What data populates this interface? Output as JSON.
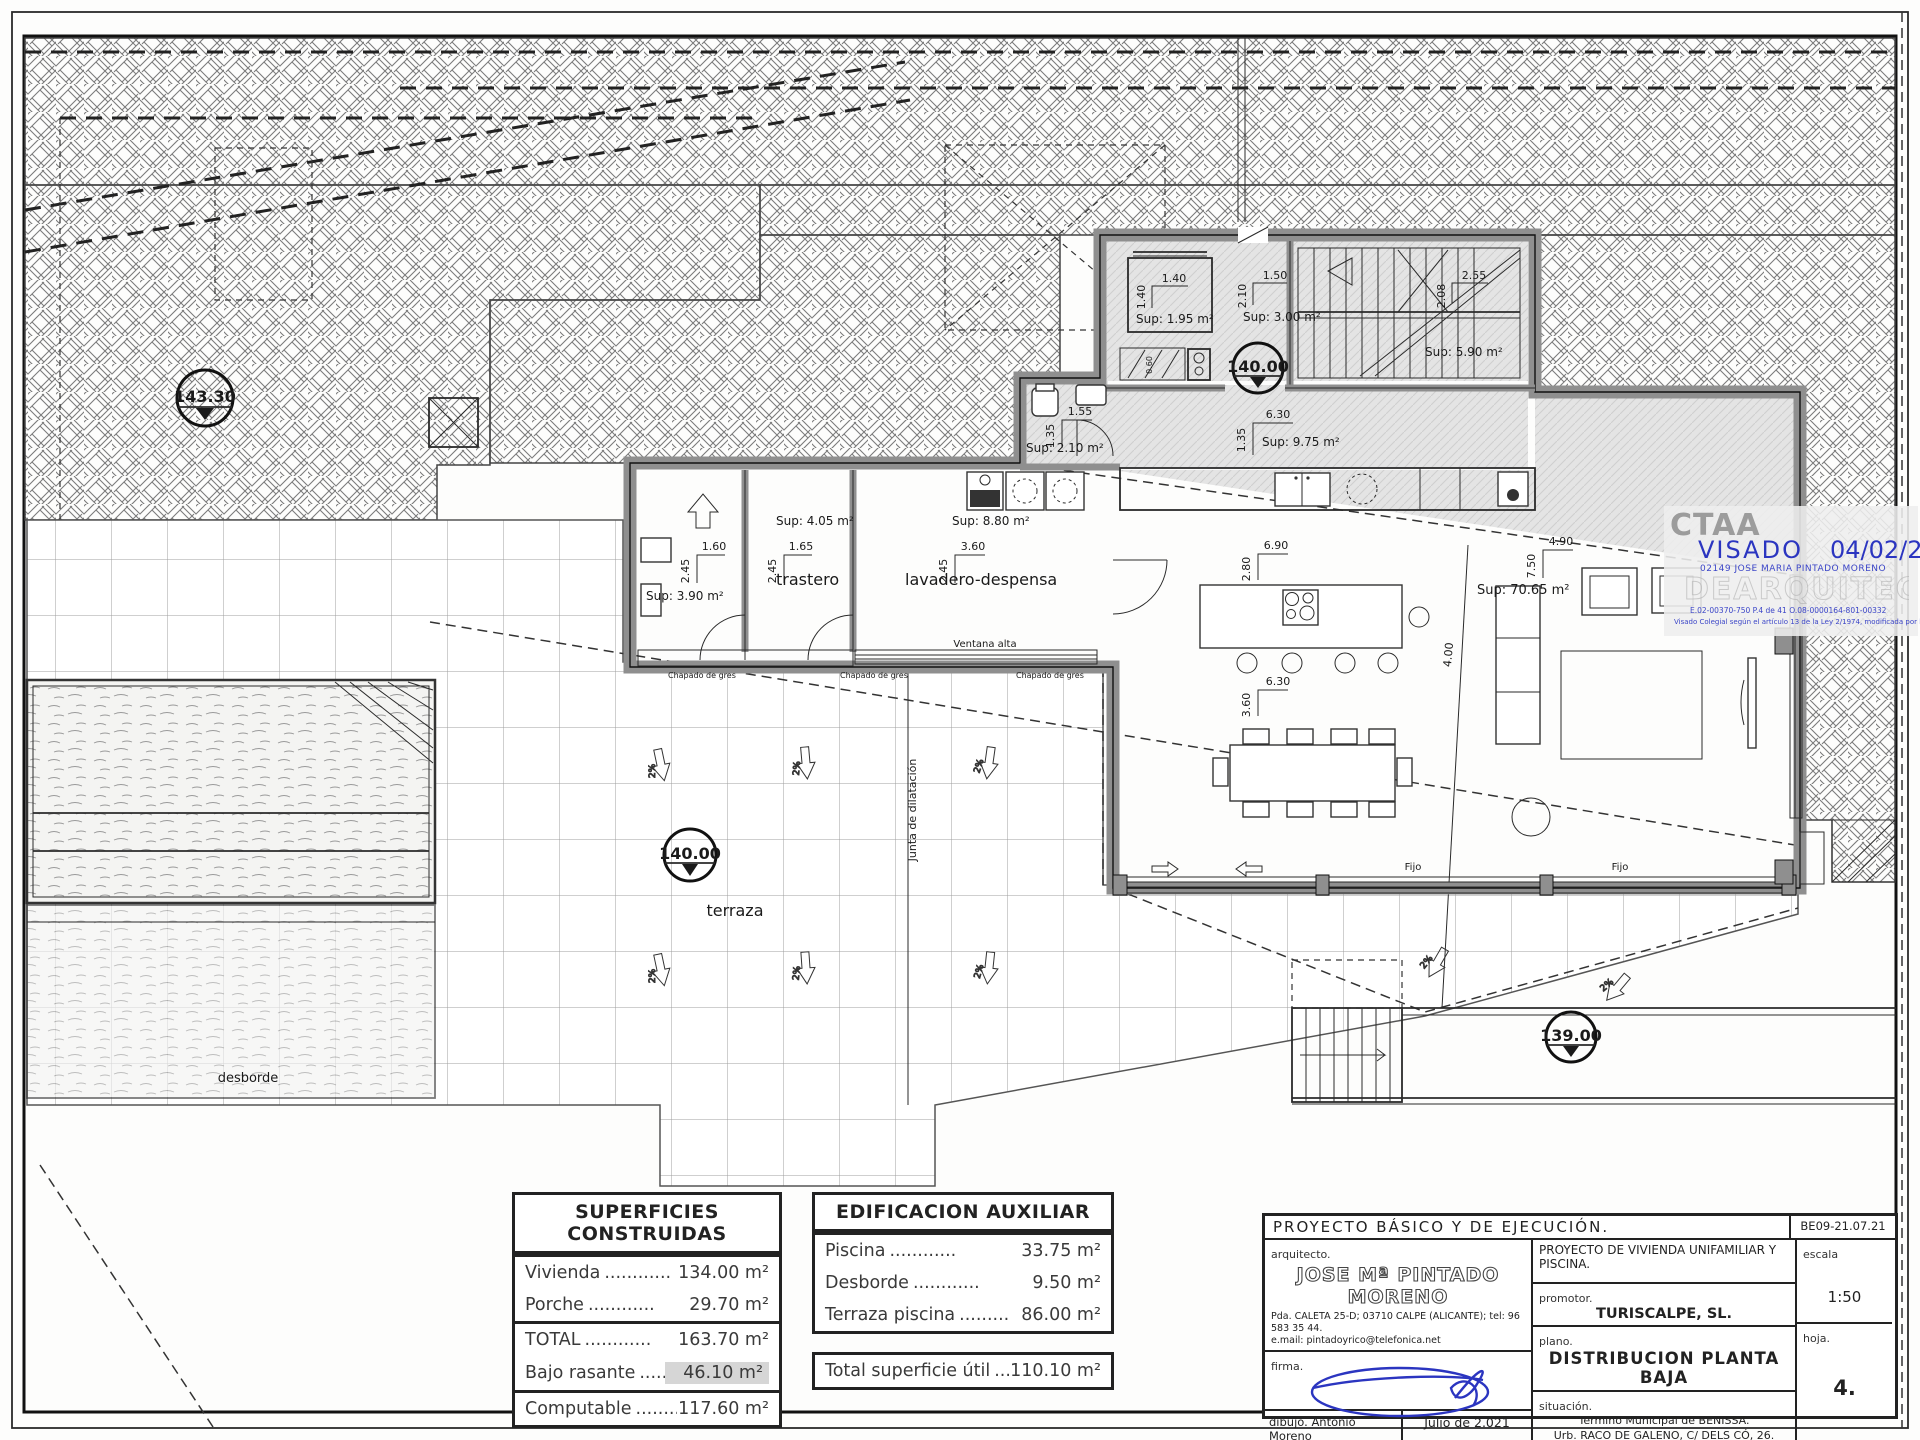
{
  "plan": {
    "markers": {
      "site_level": "143.30",
      "floor_level": "140.00",
      "terrace_level": "140.00",
      "lower_level": "139.00"
    },
    "sups": {
      "lift": "Sup: 1.95 m²",
      "hall": "Sup: 3.00 m²",
      "stairs": "Sup: 5.90 m²",
      "corridor": "Sup: 9.75 m²",
      "wc": "Sup: 2.10 m²",
      "room_a": "Sup: 3.90 m²",
      "trastero": "Sup: 4.05 m²",
      "lavadero": "Sup: 8.80 m²",
      "living": "Sup: 70.65 m²"
    },
    "rooms": {
      "trastero": "trastero",
      "lavadero": "lavadero-despensa",
      "terraza": "terraza"
    },
    "labels": {
      "desborde": "desborde",
      "ventana_alta": "Ventana alta",
      "chapado": "Chapado de gres",
      "junta": "Junta de dilatación",
      "fijo": "Fijo",
      "slope": "2%"
    },
    "dims": {
      "lift": {
        "w": "1.40",
        "h": "1.40"
      },
      "hall": {
        "w": "1.50",
        "h": "2.10"
      },
      "stairs": {
        "w": "2.55",
        "h": "2.08"
      },
      "corridor": {
        "w": "6.30",
        "h": "1.35"
      },
      "wc": {
        "w": "1.55",
        "h": "1.35"
      },
      "room_a": {
        "w": "1.60",
        "h": "2.45"
      },
      "trastero": {
        "w": "1.65",
        "h": "2.45"
      },
      "lavadero": {
        "w": "3.60",
        "h": "2.45"
      },
      "kitchen": {
        "w": "6.90",
        "h": "2.80"
      },
      "dining": {
        "w": "6.30",
        "h": "3.60"
      },
      "living": {
        "w": "4.90",
        "h": "7.50"
      },
      "diag": "4.00",
      "closet": "0.60"
    }
  },
  "tables": {
    "superficies": {
      "title": "SUPERFICIES CONSTRUIDAS",
      "rows": [
        {
          "label": "Vivienda",
          "dots": "............",
          "value": "134.00 m²"
        },
        {
          "label": "Porche",
          "dots": "............",
          "value": "29.70 m²"
        },
        {
          "label": "TOTAL",
          "dots": "............",
          "value": "163.70 m²"
        },
        {
          "label": "Bajo rasante",
          "dots": "...........",
          "value": "46.10 m²"
        },
        {
          "label": "Computable",
          "dots": ".........",
          "value": "117.60 m²"
        }
      ]
    },
    "auxiliar": {
      "title": "EDIFICACION AUXILIAR",
      "rows": [
        {
          "label": "Piscina",
          "dots": "............",
          "value": "33.75 m²"
        },
        {
          "label": "Desborde",
          "dots": "............",
          "value": "9.50 m²"
        },
        {
          "label": "Terraza piscina",
          "dots": "............",
          "value": "86.00 m²"
        }
      ]
    },
    "total_util": {
      "label": "Total superficie útil",
      "dots": ".....",
      "value": "110.10 m²"
    }
  },
  "titleblock": {
    "project_title": "PROYECTO  BÁSICO  Y  DE  EJECUCIÓN.",
    "code": "BE09-21.07.21",
    "arquitecto_label": "arquitecto.",
    "architect_name": "JOSE Mª PINTADO MORENO",
    "address_line1": "Pda. CALETA 25-D; 03710 CALPE (ALICANTE); tel: 96 583 35 44.",
    "address_line2": "e.mail: pintadoyrico@telefonica.net",
    "project_desc": "PROYECTO DE VIVIENDA UNIFAMILIAR Y PISCINA.",
    "promotor_label": "promotor.",
    "promotor": "TURISCALPE, SL.",
    "escala_label": "escala",
    "escala": "1:50",
    "firma_label": "firma.",
    "plano_label": "plano.",
    "plano": "DISTRIBUCION PLANTA BAJA",
    "situacion_label": "situación.",
    "situacion1": "Termino Municipal de BENISSA.",
    "situacion2": "Urb. RACO DE GALENO, C/ DELS CÓ, 26.",
    "hoja_label": "hoja.",
    "hoja": "4.",
    "dibujo_label": "dibujo.",
    "dibujo": "Antonio Moreno",
    "fecha": "Julio de 2.021"
  },
  "stamp": {
    "org": "CTAA",
    "visado": "VISADO",
    "fecha": "04/02/22",
    "colegiado": "02149 JOSE MARIA PINTADO MORENO",
    "watermark": "DEARQUITECTOS",
    "refs": "E.02-00370-750      P.4 de 41      O.08-0000164-801-00332",
    "legal": "Visado Colegial según el artículo 13 de la Ley 2/1974, modificada por la ley 25/2009"
  },
  "colors": {
    "stamp_blue": "#2b35c0",
    "wall_gray": "#8f8f8f",
    "floor_gray": "#e2e2e2",
    "highlight": "#d6d6d6"
  }
}
